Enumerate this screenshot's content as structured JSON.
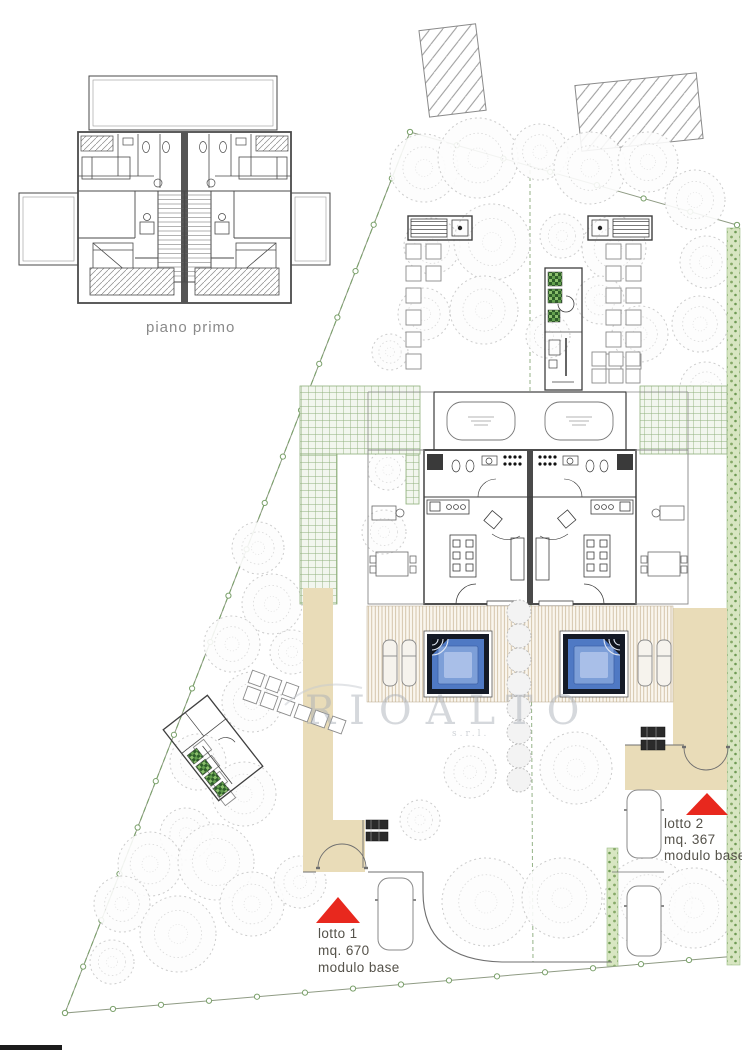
{
  "floor_plan": {
    "caption": "piano primo"
  },
  "site_plan": {
    "watermark": {
      "text": "RIOALTO",
      "suffix": "s.r.l."
    },
    "lot1": {
      "title": "lotto 1",
      "area": "mq. 670",
      "module": "modulo base"
    },
    "lot2": {
      "title": "lotto 2",
      "area": "mq. 367",
      "module": "modulo base"
    }
  },
  "colors": {
    "marker_red": "#e8281e",
    "pool_water": "#4f79c4",
    "pool_water_mid": "#7d9fd8",
    "pool_water_light": "#a9bfe8",
    "pool_frame": "#141a26",
    "sand_path": "#e9dcb8",
    "hedge_green": "#d8e6c2",
    "trellis_green": "#8fb07c",
    "boundary_green": "#7aa06a",
    "tree_gray": "#c7c7c7",
    "plan_line": "#444444"
  }
}
